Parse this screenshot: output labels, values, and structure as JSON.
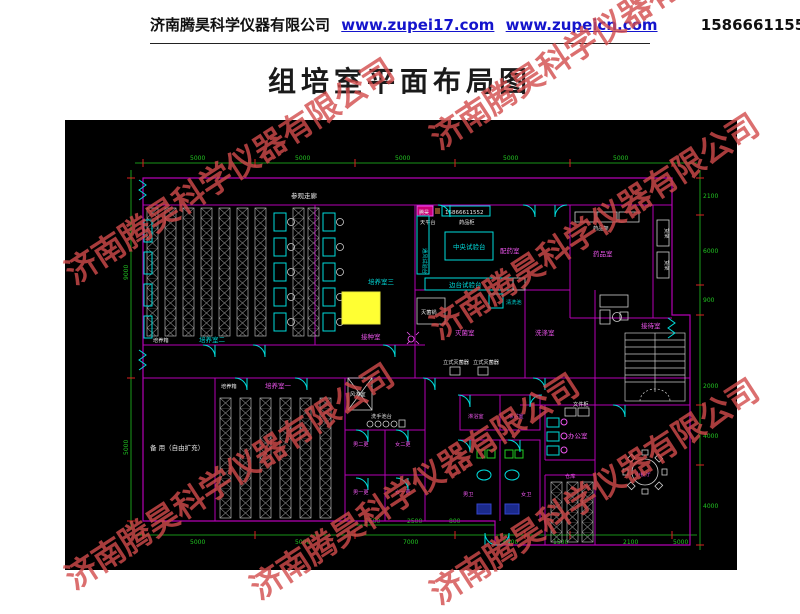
{
  "header": {
    "company": "济南腾昊科学仪器有限公司",
    "link1": "www.zupei17.com",
    "link2": "www.zupeicn.com",
    "phone": "15866611552"
  },
  "title": "组培室平面布局图",
  "watermark": {
    "text": "济南腾昊科学仪器有限公司",
    "color": "rgba(210,75,75,0.8)"
  },
  "plan": {
    "colors": {
      "background": "#000000",
      "wall": "#b400b4",
      "dimension_line": "#21c521",
      "tick": "#dd2222",
      "equipment": "#00dcdc",
      "rack": "#9a9a9a",
      "highlight": "#ffff33",
      "label_white": "#e8e8e8",
      "label_cyan": "#00dcdc",
      "label_magenta": "#ee55ee",
      "fixture_green": "#22cc22",
      "fixture_navy": "#2233aa"
    },
    "rooms": [
      {
        "label": "参观走廊"
      },
      {
        "label": "培养室二"
      },
      {
        "label": "培养室三"
      },
      {
        "label": "接种室"
      },
      {
        "label": "配药室"
      },
      {
        "label": "药品室"
      },
      {
        "label": "灭菌室"
      },
      {
        "label": "洗涤室"
      },
      {
        "label": "接待室"
      },
      {
        "label": "备 用（自由扩充）"
      },
      {
        "label": "培养室一"
      },
      {
        "label": "风淋室"
      },
      {
        "label": "男二更"
      },
      {
        "label": "女二更"
      },
      {
        "label": "男一更"
      },
      {
        "label": "女一更"
      },
      {
        "label": "淋浴室"
      },
      {
        "label": "淋浴室"
      },
      {
        "label": "男卫"
      },
      {
        "label": "女卫"
      },
      {
        "label": "办公室"
      },
      {
        "label": "仓库"
      },
      {
        "label": "小餐厅"
      }
    ],
    "equipment": [
      {
        "label": "培养箱"
      },
      {
        "label": "培养箱"
      },
      {
        "label": "中央试验台"
      },
      {
        "label": "边台试验台"
      },
      {
        "label": "通风试验台"
      },
      {
        "label": "天平台"
      },
      {
        "label": "药品柜"
      },
      {
        "label": "灭菌锅"
      },
      {
        "label": "立式灭菌器"
      },
      {
        "label": "立式灭菌器"
      },
      {
        "label": "清洗池"
      },
      {
        "label": "洗手池台"
      },
      {
        "label": "药品架"
      },
      {
        "label": "货架"
      },
      {
        "label": "货架"
      },
      {
        "label": "文件柜"
      },
      {
        "label": "腾昊"
      },
      {
        "label": "15866611552"
      }
    ],
    "dims": {
      "top": [
        "5000",
        "5000",
        "5000",
        "5000",
        "5000"
      ],
      "left": [
        "9000",
        "5000"
      ],
      "right": [
        "2100",
        "6000",
        "900",
        "2000",
        "4000",
        "4000"
      ],
      "bottom": [
        "5000",
        "5000",
        "7000",
        "6000",
        "1500",
        "2100",
        "5000"
      ],
      "bottom_inner": [
        "2500",
        "2500",
        "800"
      ]
    }
  }
}
